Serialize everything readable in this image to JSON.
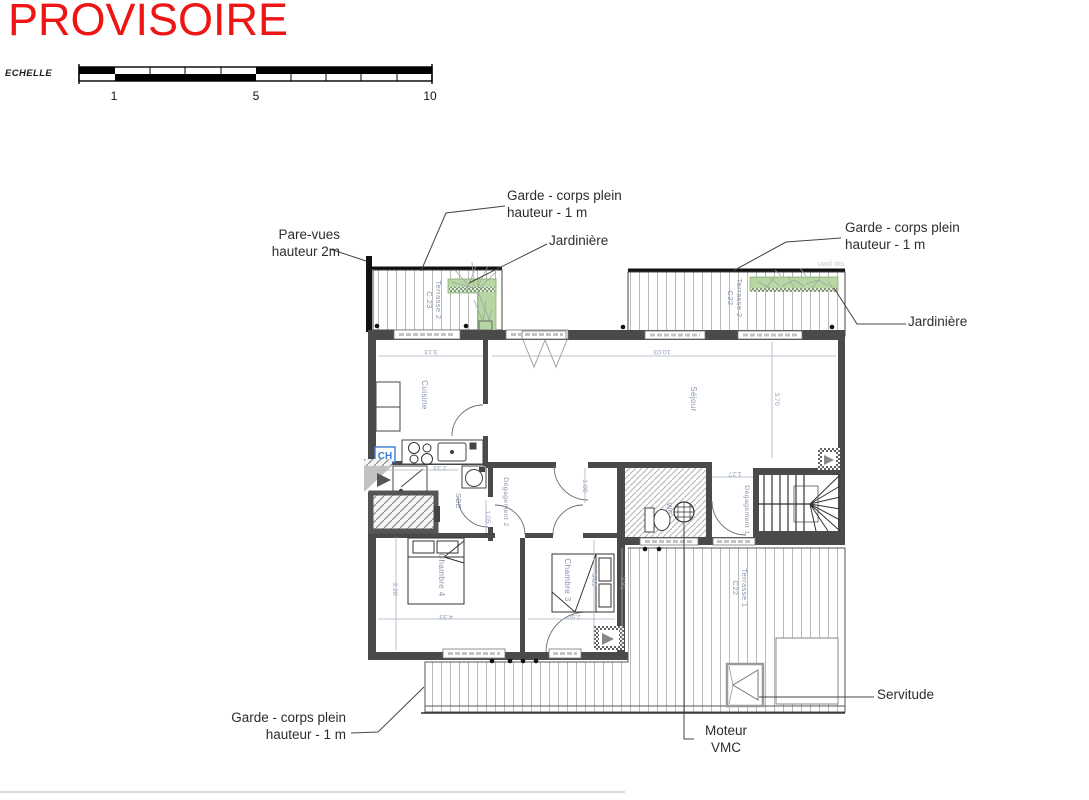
{
  "stamp": {
    "text": "PROVISOIRE",
    "color": "#ee1515"
  },
  "scale_bar": {
    "label": "ECHELLE",
    "ticks": [
      "1",
      "5",
      "10"
    ]
  },
  "annotations": {
    "pare_vues": "Pare-vues\nhauteur  2m",
    "garde_corps_top": "Garde - corps plein\nhauteur - 1 m",
    "jardiniere_top": "Jardinière",
    "garde_corps_right": "Garde - corps plein\nhauteur - 1 m",
    "jardiniere_right": "Jardinière",
    "garde_corps_bottom": "Garde - corps plein\nhauteur - 1 m",
    "moteur_vmc": "Moteur\nVMC",
    "servitude": "Servitude",
    "top_plan": "top plan"
  },
  "rooms": {
    "cuisine": "Cuisine",
    "sejour": "Séjour",
    "chambre3": "Chambre 3",
    "chambre4": "Chambre 4",
    "degagement1": "Dégagement 1",
    "degagement2": "Dégagement 2",
    "wc": "WC",
    "sde": "SDE",
    "ch": "CH"
  },
  "terraces": {
    "left": {
      "name": "Terrasse 2",
      "code": "C.23"
    },
    "top_right": {
      "name": "Terrasse 2",
      "code": "C22"
    },
    "bottom": {
      "name": "Terrasse 1",
      "code": "C22"
    }
  },
  "dimensions": {
    "cuisine_width": "3.13",
    "sejour_width": "10.03",
    "sejour_depth": "3.70",
    "sde_width": "2.33",
    "degagement2_width": "1.05",
    "door_width": "1.00",
    "degagement1_width": "1.27",
    "chambre4_depth": "3.20",
    "chambre4_width": "4.33",
    "chambre3_width": "2.50",
    "chambre3_depth": "3.01",
    "terrasse_depth": "3.81"
  },
  "colors": {
    "stamp_red": "#ee1515",
    "jardiniere_green": "#b6d7a4",
    "wall_gray": "#4a4a4a",
    "room_label_blue": "#8696ac",
    "dimension_blue": "#93a1b6"
  }
}
